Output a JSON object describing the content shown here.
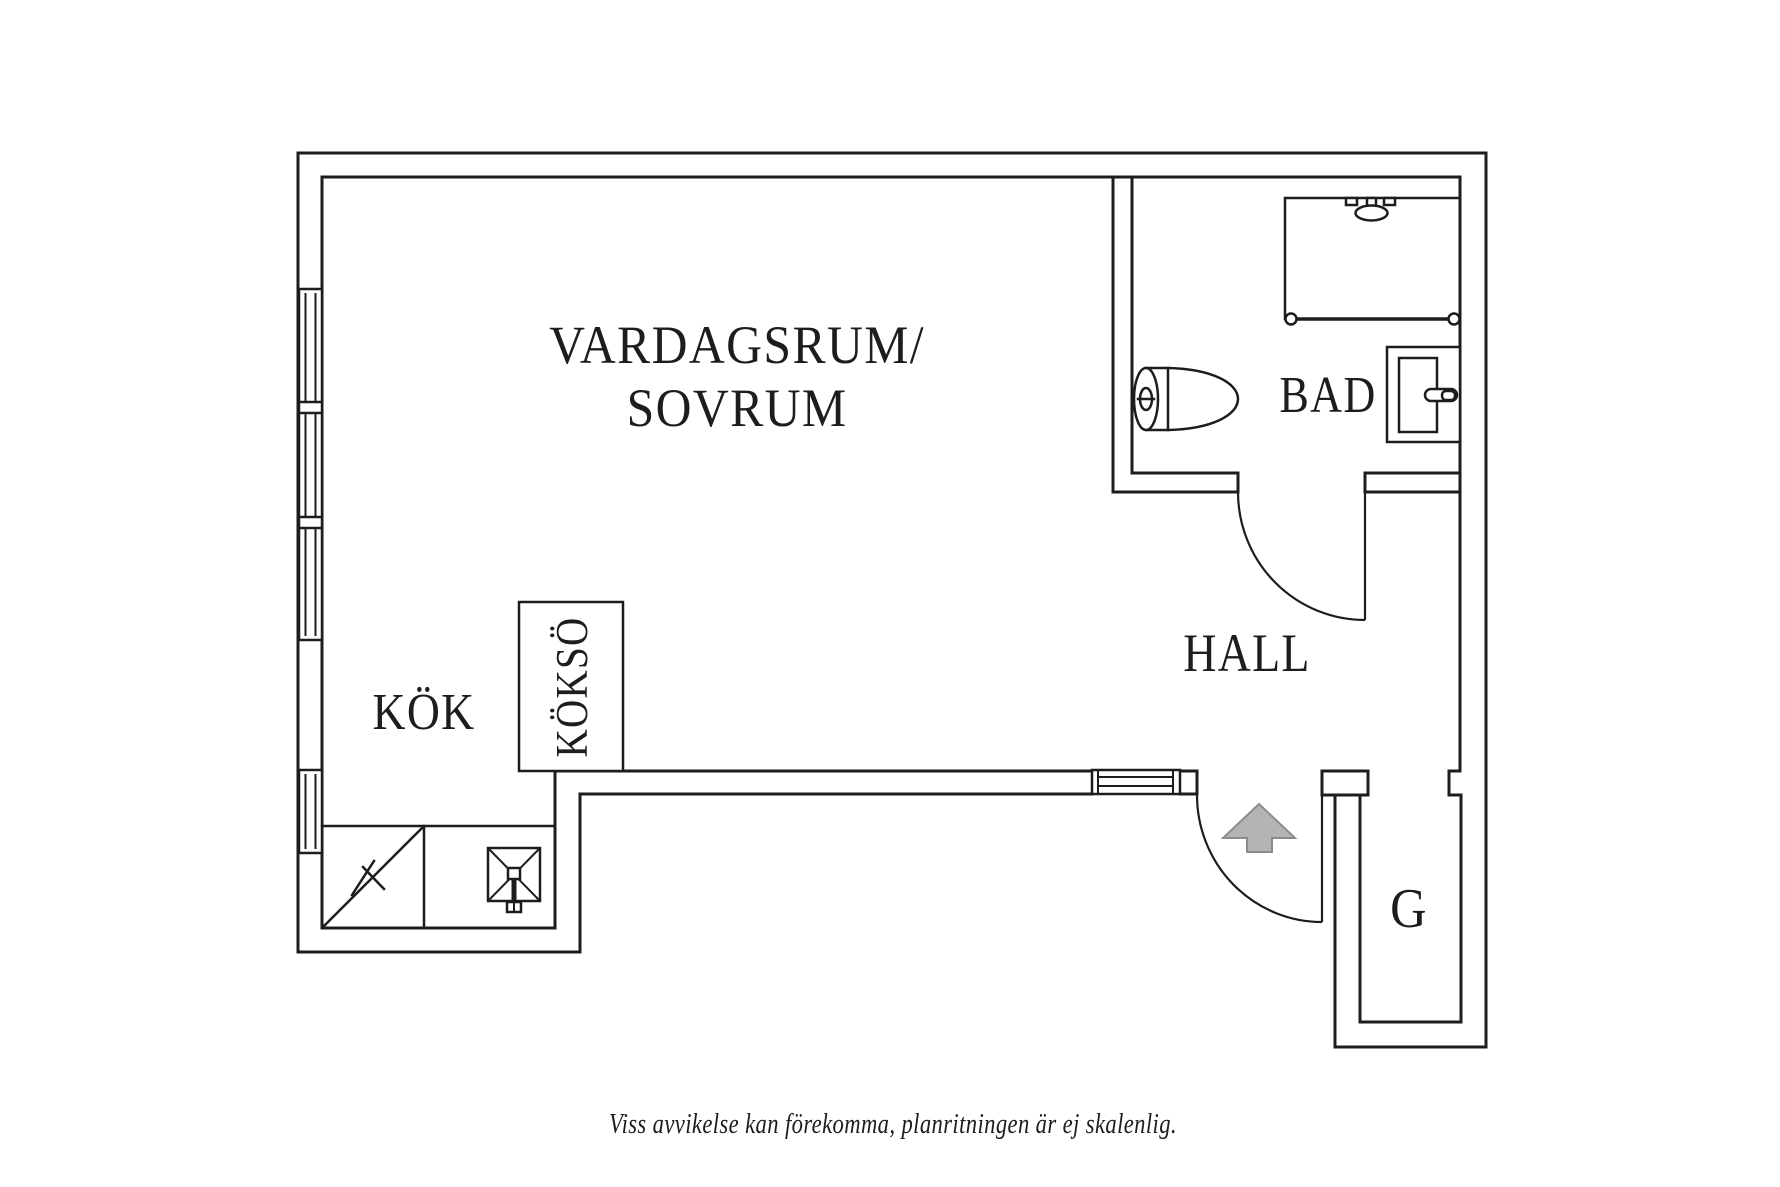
{
  "rooms": {
    "living_room": {
      "label_line1": "VARDAGSRUM/",
      "label_line2": "SOVRUM"
    },
    "kitchen": {
      "label": "KÖK"
    },
    "kitchen_island": {
      "label": "KÖKSÖ"
    },
    "bathroom": {
      "label": "BAD"
    },
    "hall": {
      "label": "HALL"
    },
    "wardrobe": {
      "label": "G"
    }
  },
  "caption": "Viss avvikelse kan förekomma, planritningen är ej skalenlig.",
  "colors": {
    "background": "#ffffff",
    "line": "#1d1d1b",
    "arrow_fill": "#b5b4b2",
    "arrow_stroke": "#8c8c8a"
  },
  "icons": {
    "entrance": "arrow-up",
    "shower": "shower-head",
    "toilet": "toilet-top-view",
    "bathroom_sink": "washbasin",
    "kitchen_sink": "sink-with-cross",
    "kitchen_counter": "counter-diagonal-mark",
    "windows": "double-line-window"
  }
}
